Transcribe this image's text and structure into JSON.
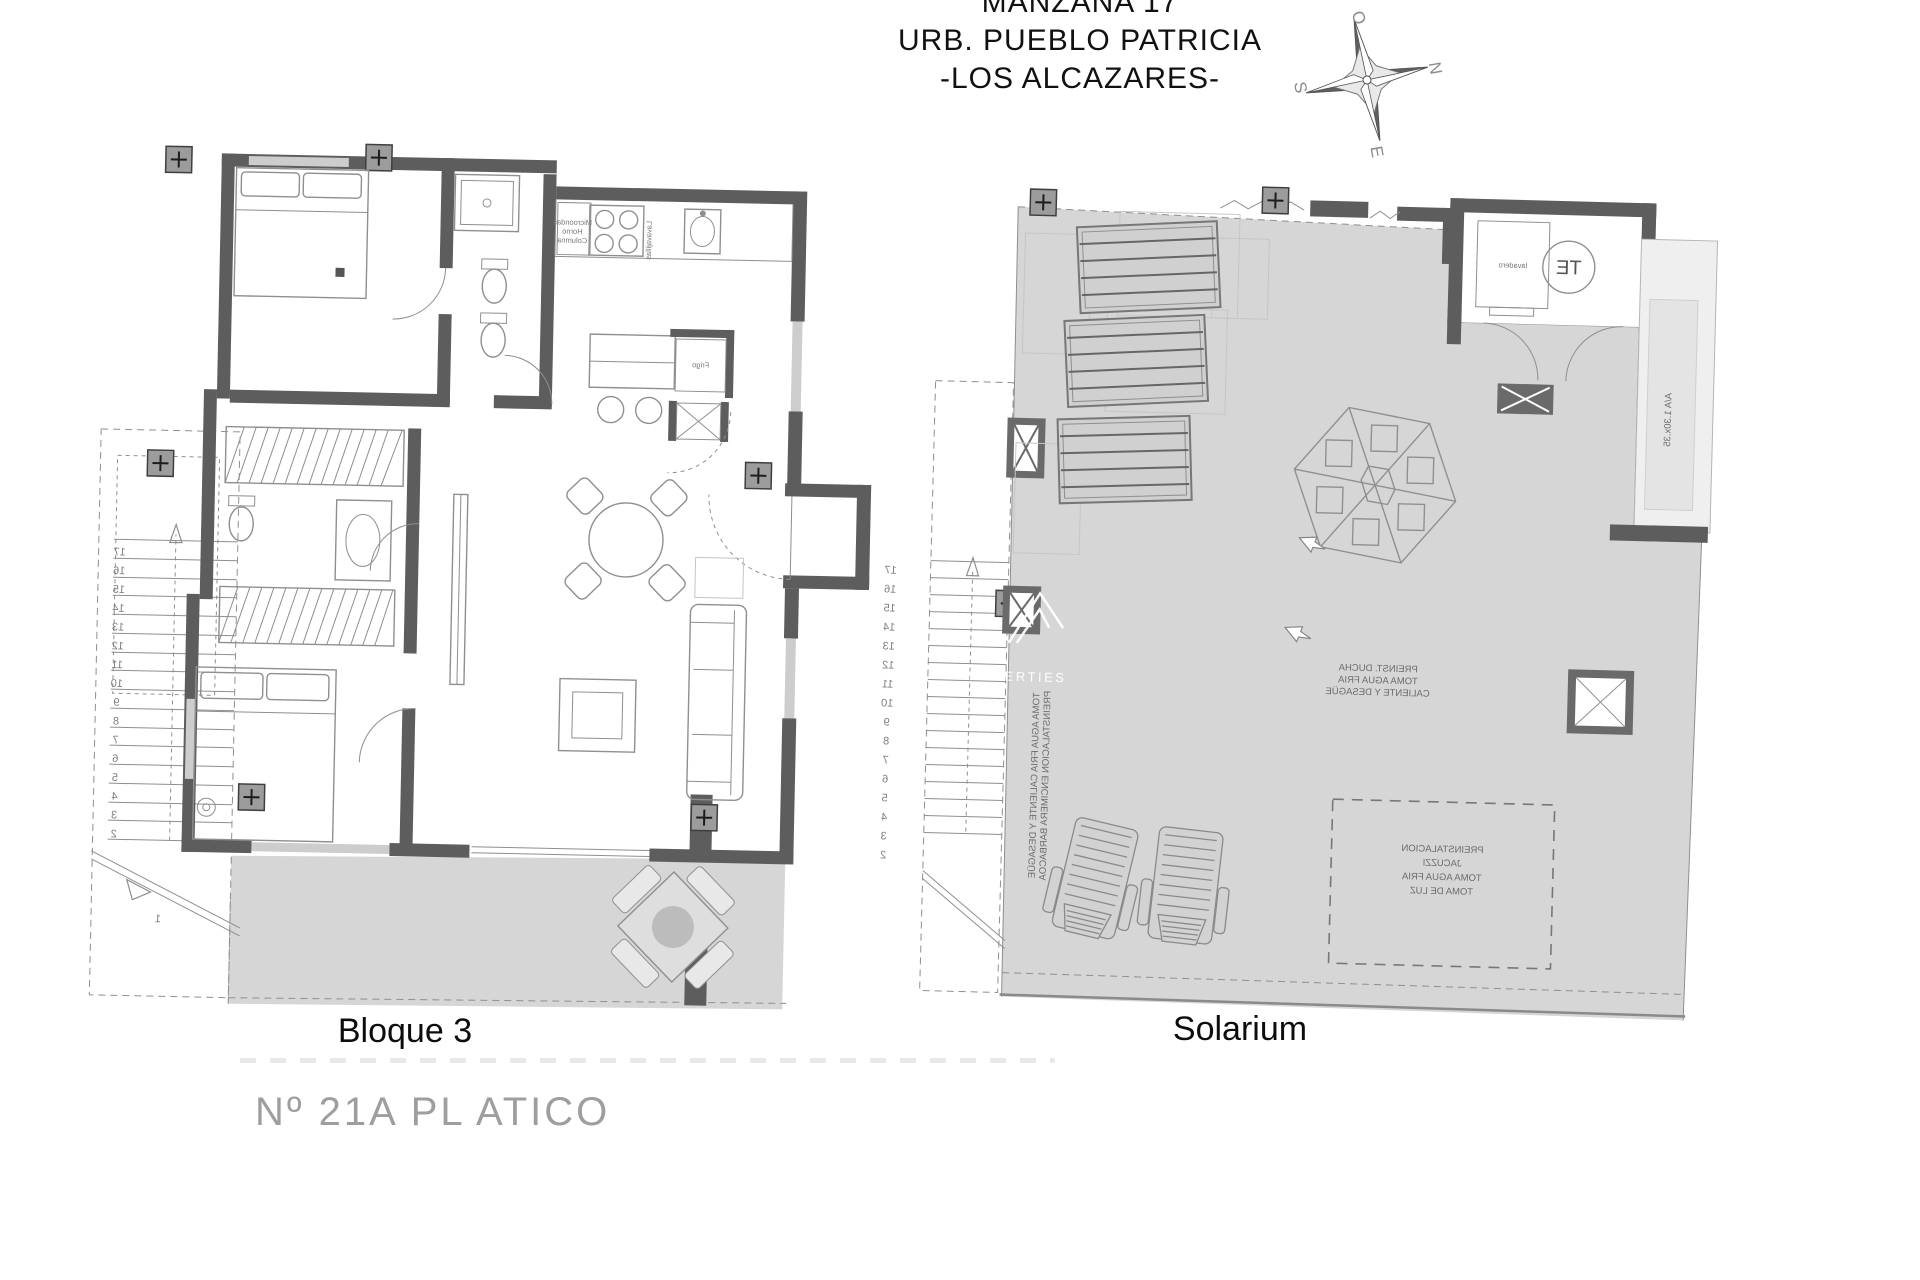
{
  "header": {
    "line1": "MANZANA 17",
    "line2": "URB. PUEBLO PATRICIA",
    "line3": "-LOS ALCAZARES-"
  },
  "compass": {
    "n": "N",
    "s": "S",
    "e": "E",
    "w": "O"
  },
  "watermark": {
    "text": "PROPERTIES"
  },
  "plans": {
    "bloque3": {
      "title": "Bloque 3",
      "unit_label": "Nº 21A PL ATICO",
      "annotations": {
        "column_unit": [
          "Microondas",
          "Horno",
          "Columna"
        ],
        "dishwasher": "Lavavajillas",
        "fridge": "Frigo"
      }
    },
    "solarium": {
      "title": "Solarium",
      "annotations": {
        "water_heater": "TE",
        "laundry": "lavadero",
        "shower": [
          "PREINST. DUCHA",
          "TOMA AGUA FRIA",
          "CALIENTE Y DESAGÜE"
        ],
        "barbecue": [
          "TOMA AGUA FRIA CALIENTE Y DESAGÜE",
          "PREINSTALACION ENCIMERA BARBACOA"
        ],
        "jacuzzi": [
          "PREINSTALACION",
          "JACUZZI",
          "TOMA AGUA FRIA",
          "TOMA DE LUZ"
        ],
        "ac_unit": "A/A 1.30x.35"
      }
    }
  },
  "stairs": {
    "numbers": [
      "17",
      "16",
      "15",
      "14",
      "13",
      "12",
      "11",
      "10",
      "9",
      "8",
      "7",
      "6",
      "5",
      "4",
      "3",
      "2"
    ],
    "first": "1"
  },
  "colors": {
    "wall": "#5d5d5d",
    "terrace_fill": "#d6d6d6",
    "drawing_line": "#8f8f8f",
    "label_gray": "#9e9e9e",
    "ink": "#1a1a1a"
  }
}
